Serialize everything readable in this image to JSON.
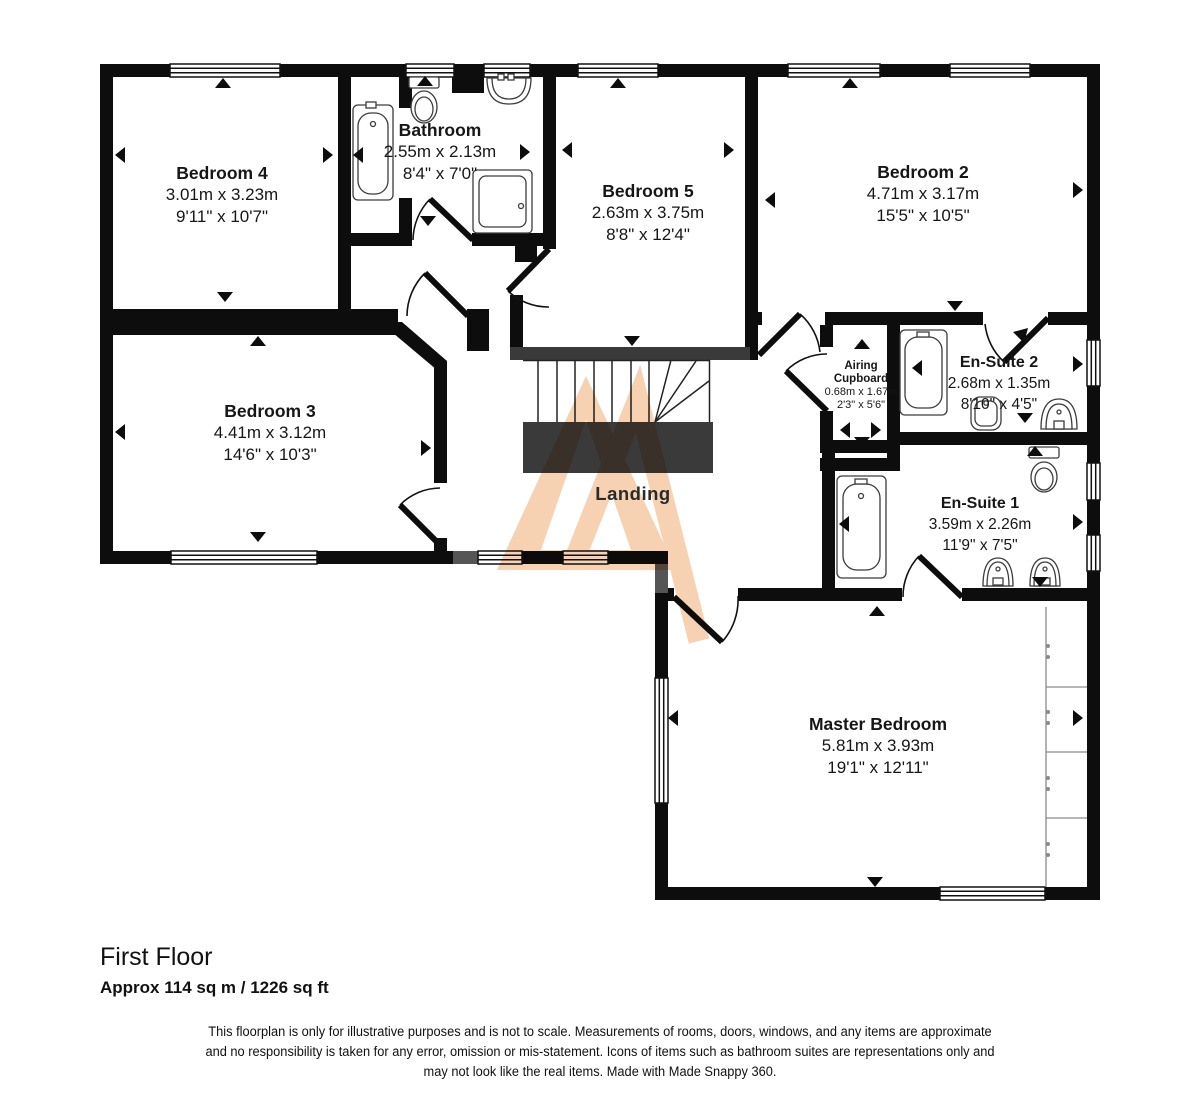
{
  "floorplan": {
    "rooms": {
      "bedroom4": {
        "name": "Bedroom 4",
        "metric": "3.01m x 3.23m",
        "imperial": "9'11\" x 10'7\""
      },
      "bathroom": {
        "name": "Bathroom",
        "metric": "2.55m x 2.13m",
        "imperial": "8'4\" x 7'0\""
      },
      "bedroom5": {
        "name": "Bedroom 5",
        "metric": "2.63m x 3.75m",
        "imperial": "8'8\" x 12'4\""
      },
      "bedroom2": {
        "name": "Bedroom 2",
        "metric": "4.71m x 3.17m",
        "imperial": "15'5\" x 10'5\""
      },
      "bedroom3": {
        "name": "Bedroom 3",
        "metric": "4.41m x 3.12m",
        "imperial": "14'6\" x 10'3\""
      },
      "airing_cupboard": {
        "name": "Airing Cupboard",
        "metric": "0.68m x 1.67m",
        "imperial": "2'3\" x 5'6\""
      },
      "ensuite2": {
        "name": "En-Suite 2",
        "metric": "2.68m x 1.35m",
        "imperial": "8'10\" x 4'5\""
      },
      "ensuite1": {
        "name": "En-Suite 1",
        "metric": "3.59m x 2.26m",
        "imperial": "11'9\" x 7'5\""
      },
      "master_bedroom": {
        "name": "Master Bedroom",
        "metric": "5.81m x 3.93m",
        "imperial": "19'1\" x 12'11\""
      },
      "landing": {
        "name": "Landing"
      }
    },
    "footer": {
      "floor_title": "First Floor",
      "floor_area": "Approx 114 sq m / 1226 sq ft",
      "disclaimer": [
        "This floorplan is only for illustrative purposes and is not to scale. Measurements of rooms, doors, windows, and any items are approximate",
        "and no responsibility is taken for any error, omission or mis-statement. Icons of items such as bathroom suites are representations only and",
        "may not look like the real items. Made with Made Snappy 360."
      ]
    },
    "colors": {
      "wall": "#0d0d0d",
      "stairs": "#3a3a3a",
      "watermark": "#f6cfae"
    }
  }
}
